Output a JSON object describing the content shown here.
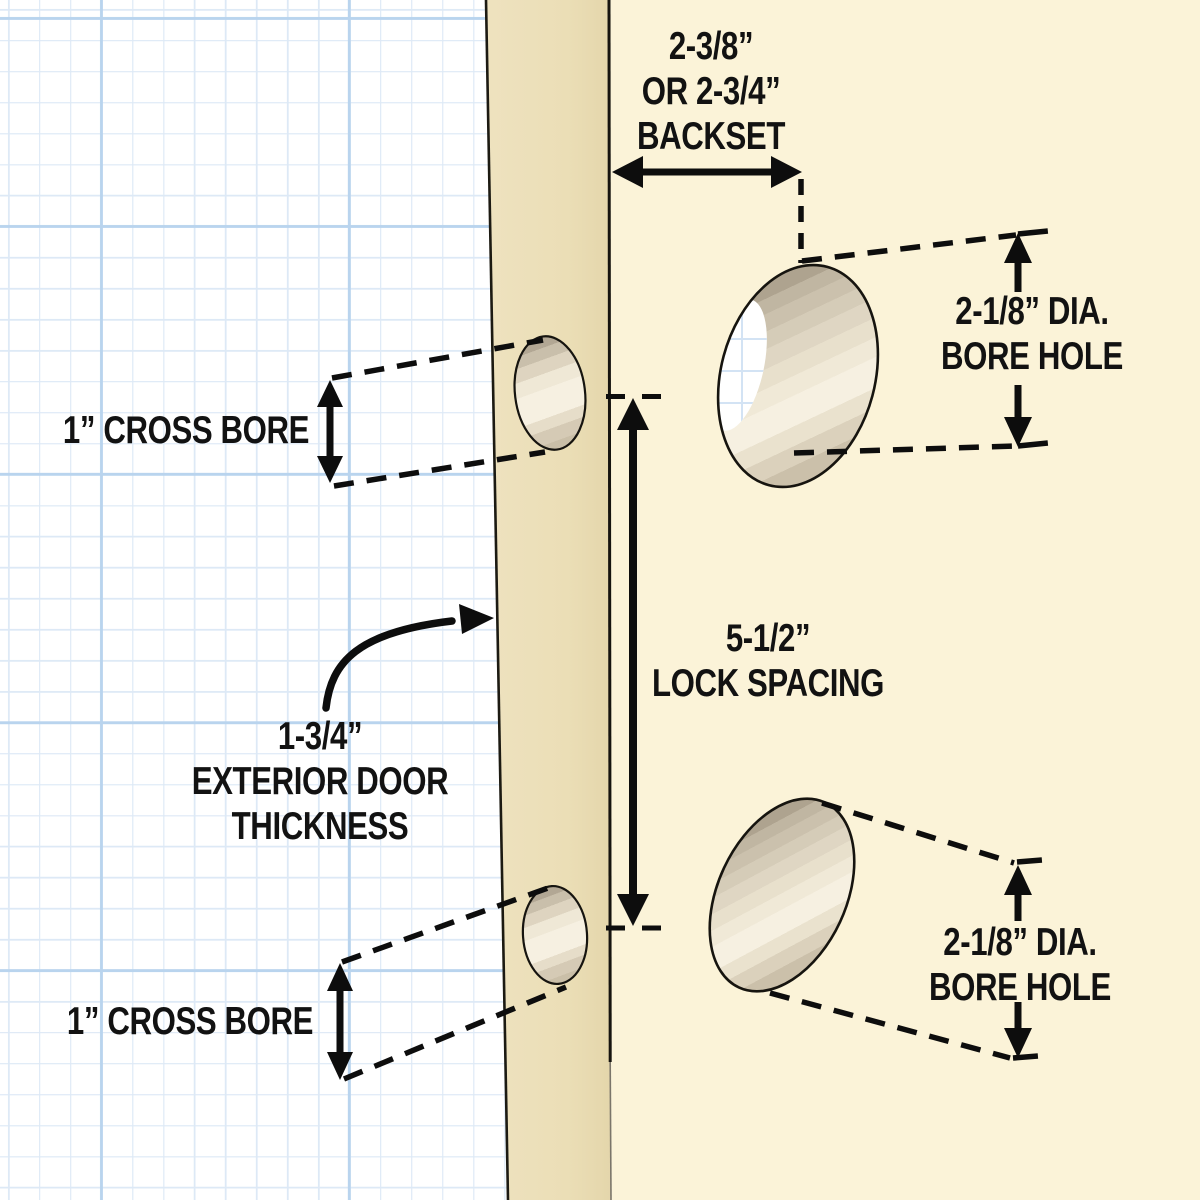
{
  "diagram": {
    "subject": "door lock installation measurements",
    "labels": {
      "backset": {
        "lines": [
          "2-3/8”",
          "OR 2-3/4”",
          "BACKSET"
        ]
      },
      "bore_top": {
        "lines": [
          "2-1/8” DIA.",
          "BORE HOLE"
        ]
      },
      "cross_bore_top": {
        "text": "1” CROSS BORE"
      },
      "lock_spacing": {
        "lines": [
          "5-1/2”",
          "LOCK SPACING"
        ]
      },
      "door_thickness": {
        "lines": [
          "1-3/4”",
          "EXTERIOR DOOR",
          "THICKNESS"
        ]
      },
      "cross_bore_bottom": {
        "text": "1” CROSS BORE"
      },
      "bore_bottom": {
        "lines": [
          "2-1/8” DIA.",
          "BORE HOLE"
        ]
      }
    },
    "colors": {
      "paper": "#ffffff",
      "grid_minor": "#dde9f6",
      "grid_major": "#b9d4ee",
      "door_face": "#fbf3d8",
      "door_edge": "#ecdfb9",
      "outline": "#16140f",
      "bore_dark": "#aea38f",
      "bore_light": "#f6f0e1",
      "text": "#121212",
      "arrow": "#0d0d0d"
    }
  }
}
